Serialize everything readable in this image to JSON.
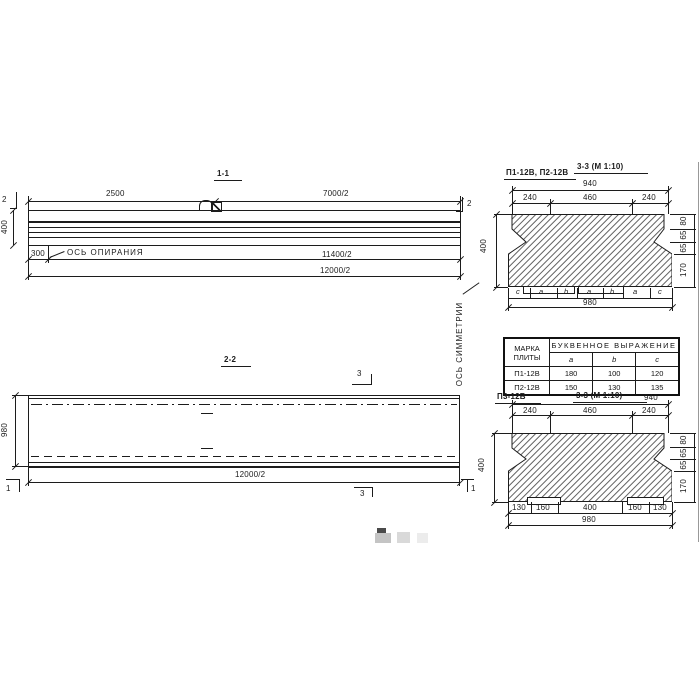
{
  "sec11": {
    "title": "1-1",
    "dim_2500": "2500",
    "dim_7000": "7000/2",
    "dim_height": "400",
    "dim_300": "300",
    "support_axis_label": "ОСЬ ОПИРАНИЯ",
    "dim_11400": "11400/2",
    "dim_12000": "12000/2",
    "cut_left": "2",
    "cut_right": "2"
  },
  "sec22": {
    "title": "2-2",
    "dim_width": "980",
    "dim_12000": "12000/2",
    "cut_top": "3",
    "cut_bottom": "3",
    "cut_left": "1",
    "cut_right": "1",
    "symmetry_axis_label": "ОСЬ СИММЕТРИИ"
  },
  "sec33_top": {
    "label": "П1-12В, П2-12В",
    "title": "3-3 (М 1:10)",
    "dim_940": "940",
    "dims_top": [
      "240",
      "460",
      "240"
    ],
    "dim_400": "400",
    "dims_right": [
      "80",
      "65",
      "65",
      "170"
    ],
    "letters": [
      "c",
      "a",
      "b",
      "a",
      "b",
      "a",
      "c"
    ],
    "dim_980": "980"
  },
  "table": {
    "header_mark_line1": "МАРКА",
    "header_mark_line2": "ПЛИТЫ",
    "header_expression": "БУКВЕННОЕ ВЫРАЖЕНИЕ",
    "col_headers": [
      "a",
      "b",
      "c"
    ],
    "rows": [
      {
        "mark": "П1-12В",
        "a": "180",
        "b": "100",
        "c": "120"
      },
      {
        "mark": "П2-12В",
        "a": "150",
        "b": "130",
        "c": "135"
      }
    ]
  },
  "sec33_bottom": {
    "label": "П3-12В",
    "title": "3-3 (М 1:10)",
    "dim_940": "940",
    "dims_top": [
      "240",
      "460",
      "240"
    ],
    "dim_400": "400",
    "dims_right": [
      "80",
      "65",
      "65",
      "170"
    ],
    "dims_bottom": [
      "130",
      "160",
      "400",
      "160",
      "130"
    ],
    "dim_980": "980"
  },
  "colors": {
    "line": "#1c1c1c",
    "background": "#ffffff"
  }
}
